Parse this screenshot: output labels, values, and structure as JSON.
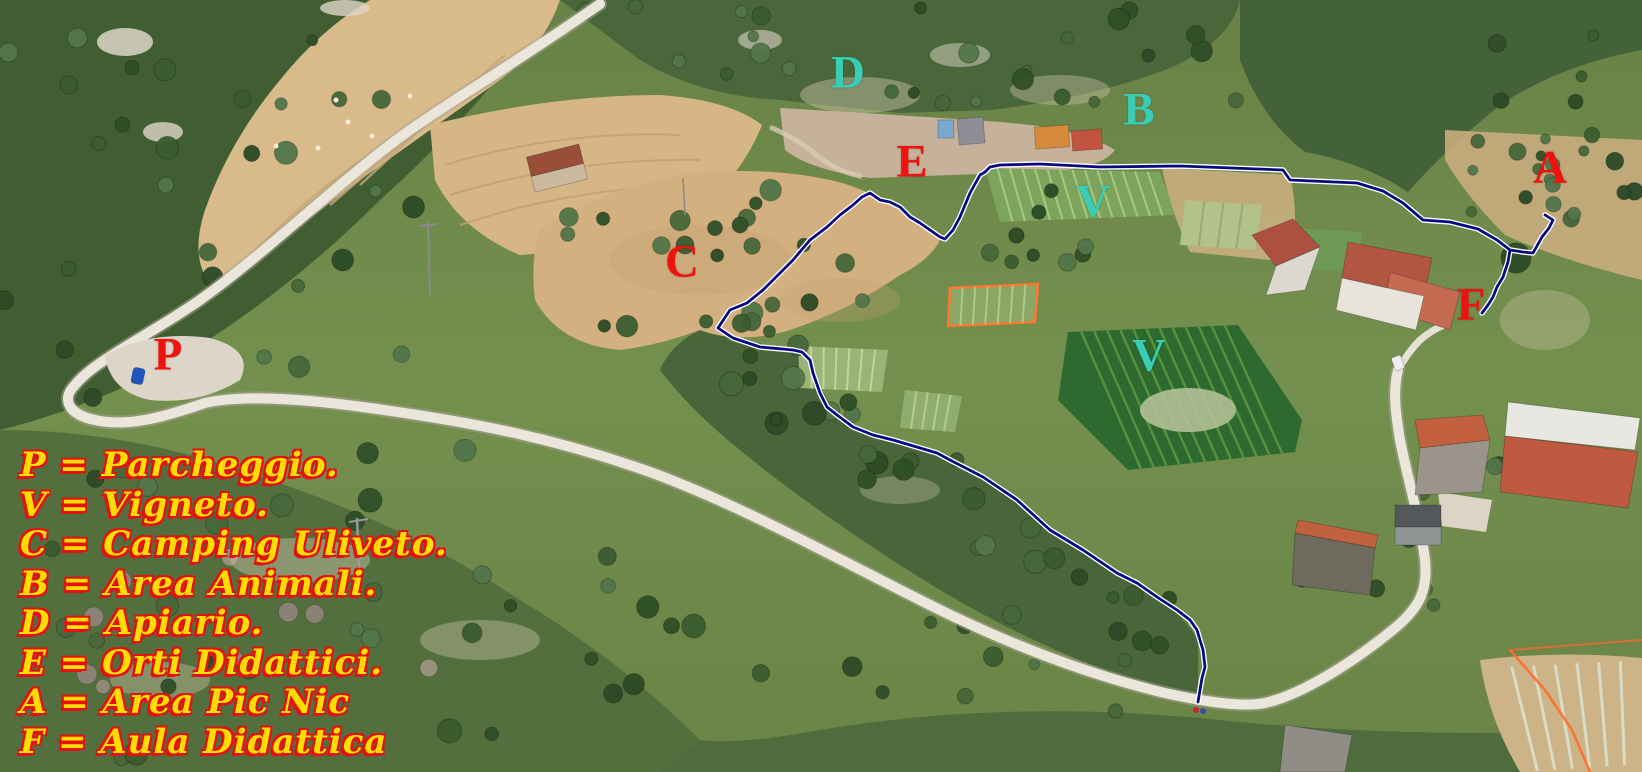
{
  "canvas": {
    "width": 1642,
    "height": 772
  },
  "colors": {
    "marker_red": "#ef1310",
    "marker_teal": "#38cdb4",
    "legend_fill": "#ffdd00",
    "legend_shadow": "#e41111",
    "boundary_navy": "#0a0a80",
    "boundary_casing": "#ffffff"
  },
  "markers": [
    {
      "id": "D",
      "label": "D",
      "color": "teal",
      "x": 848,
      "y": 73,
      "meaning": "Apiario"
    },
    {
      "id": "B",
      "label": "B",
      "color": "teal",
      "x": 1139,
      "y": 110,
      "meaning": "Area Animali"
    },
    {
      "id": "E",
      "label": "E",
      "color": "red",
      "x": 912,
      "y": 162,
      "meaning": "Orti Didattici"
    },
    {
      "id": "V1",
      "label": "V",
      "color": "teal",
      "x": 1093,
      "y": 202,
      "meaning": "Vigneto"
    },
    {
      "id": "A",
      "label": "A",
      "color": "red",
      "x": 1550,
      "y": 168,
      "meaning": "Area Pic Nic"
    },
    {
      "id": "C",
      "label": "C",
      "color": "red",
      "x": 682,
      "y": 262,
      "meaning": "Camping Uliveto"
    },
    {
      "id": "F",
      "label": "F",
      "color": "red",
      "x": 1471,
      "y": 305,
      "meaning": "Aula Didattica"
    },
    {
      "id": "P",
      "label": "P",
      "color": "red",
      "x": 168,
      "y": 355,
      "meaning": "Parcheggio"
    },
    {
      "id": "V2",
      "label": "V",
      "color": "teal",
      "x": 1149,
      "y": 356,
      "meaning": "Vigneto"
    }
  ],
  "legend": {
    "items": [
      {
        "key": "P",
        "text": "P = Parcheggio."
      },
      {
        "key": "V",
        "text": "V = Vigneto."
      },
      {
        "key": "C",
        "text": "C = Camping Uliveto."
      },
      {
        "key": "B",
        "text": "B = Area Animali."
      },
      {
        "key": "D",
        "text": "D = Apiario."
      },
      {
        "key": "E",
        "text": "E = Orti Didattici."
      },
      {
        "key": "A",
        "text": "A = Area Pic Nic"
      },
      {
        "key": "F",
        "text": "F = Aula Didattica"
      }
    ]
  },
  "boundary": {
    "main_path": [
      [
        1198,
        702
      ],
      [
        1202,
        678
      ],
      [
        1205,
        667
      ],
      [
        1203,
        650
      ],
      [
        1197,
        630
      ],
      [
        1190,
        620
      ],
      [
        1177,
        610
      ],
      [
        1157,
        597
      ],
      [
        1137,
        583
      ],
      [
        1117,
        573
      ],
      [
        1083,
        550
      ],
      [
        1050,
        530
      ],
      [
        1017,
        500
      ],
      [
        983,
        477
      ],
      [
        950,
        460
      ],
      [
        937,
        453
      ],
      [
        910,
        445
      ],
      [
        893,
        440
      ],
      [
        873,
        435
      ],
      [
        853,
        427
      ],
      [
        837,
        415
      ],
      [
        827,
        407
      ],
      [
        820,
        393
      ],
      [
        813,
        373
      ],
      [
        810,
        360
      ],
      [
        802,
        352
      ],
      [
        793,
        350
      ],
      [
        760,
        347
      ],
      [
        733,
        338
      ],
      [
        718,
        328
      ],
      [
        730,
        310
      ],
      [
        747,
        303
      ],
      [
        763,
        290
      ],
      [
        780,
        273
      ],
      [
        793,
        260
      ],
      [
        810,
        240
      ],
      [
        827,
        227
      ],
      [
        840,
        215
      ],
      [
        853,
        205
      ],
      [
        862,
        197
      ],
      [
        870,
        193
      ],
      [
        880,
        200
      ],
      [
        890,
        202
      ],
      [
        900,
        207
      ],
      [
        910,
        217
      ],
      [
        920,
        223
      ],
      [
        930,
        230
      ],
      [
        940,
        237
      ],
      [
        945,
        239
      ],
      [
        953,
        230
      ],
      [
        960,
        217
      ],
      [
        965,
        205
      ],
      [
        970,
        193
      ],
      [
        980,
        175
      ],
      [
        985,
        172
      ],
      [
        990,
        167
      ],
      [
        1000,
        165
      ],
      [
        1040,
        164
      ],
      [
        1100,
        167
      ],
      [
        1180,
        166
      ],
      [
        1283,
        170
      ],
      [
        1290,
        180
      ],
      [
        1357,
        183
      ],
      [
        1383,
        191
      ],
      [
        1403,
        203
      ],
      [
        1423,
        220
      ],
      [
        1450,
        222
      ],
      [
        1478,
        229
      ],
      [
        1497,
        240
      ],
      [
        1510,
        250
      ],
      [
        1523,
        252
      ],
      [
        1533,
        253
      ],
      [
        1542,
        237
      ],
      [
        1549,
        228
      ],
      [
        1553,
        220
      ],
      [
        1545,
        215
      ]
    ],
    "branch_path": [
      [
        1510,
        250
      ],
      [
        1508,
        262
      ],
      [
        1503,
        277
      ],
      [
        1497,
        287
      ],
      [
        1493,
        297
      ],
      [
        1488,
        305
      ],
      [
        1482,
        313
      ]
    ]
  }
}
